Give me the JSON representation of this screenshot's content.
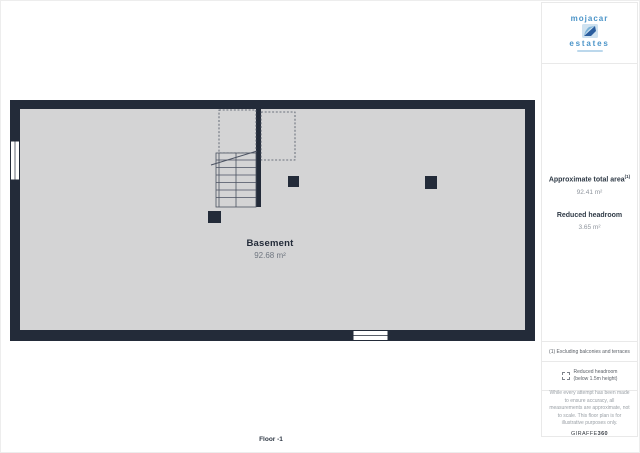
{
  "colors": {
    "wall": "#232b39",
    "floor_fill": "#d4d4d5",
    "logo_blue": "#4b94c8",
    "divider": "#e9e9e9",
    "heading_text": "#2f3a46",
    "muted_text": "#8f959d"
  },
  "logo": {
    "top": "mojacar",
    "bottom": "estates"
  },
  "sidebar": {
    "total_area_label": "Approximate total area",
    "total_area_sup": "(1)",
    "total_area_value": "92.41 m²",
    "headroom_label": "Reduced headroom",
    "headroom_value": "3.65 m²",
    "footnote": "(1) Excluding balconies and terraces",
    "legend": {
      "icon": "dashed-square",
      "line1": "Reduced headroom",
      "line2": "(below 1.5m height)"
    },
    "disclaimer": "While every attempt has been made to ensure accuracy, all measurements are approximate, not to scale. This floor plan is for illustrative purposes only.",
    "brand_light": "GIRAFFE",
    "brand_bold": "360"
  },
  "plan": {
    "room_label": "Basement",
    "room_area": "92.68 m²",
    "floor_label": "Floor -1"
  }
}
